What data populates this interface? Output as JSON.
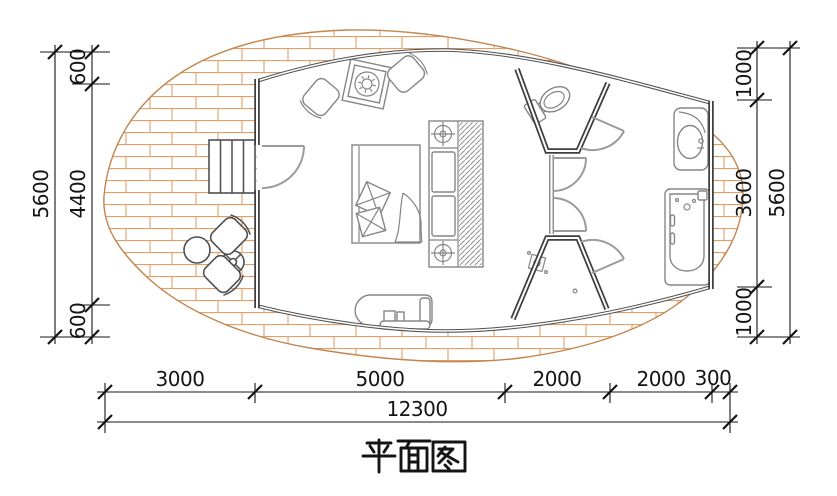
{
  "title": {
    "text": "平面图"
  },
  "dimensions": {
    "left": {
      "overall": "5600",
      "segments": [
        "600",
        "4400",
        "600"
      ]
    },
    "right": {
      "overall": "5600",
      "segments": [
        "1000",
        "3600",
        "1000"
      ]
    },
    "bottom": {
      "overall": "12300",
      "segments": [
        "3000",
        "5000",
        "2000",
        "2000",
        "300"
      ]
    }
  },
  "colors": {
    "brick": "#dfa06a",
    "deck_outline": "#c4854e",
    "wall": "#3f3f3f",
    "window": "#515151",
    "furniture": "#858585",
    "outdoor_furniture": "#4f4f4f",
    "door": "#9b9b9b",
    "dimension": "#141414"
  },
  "fixtures": [
    "entry-steps",
    "entry-door",
    "lounge-chair-left",
    "side-table",
    "lounge-chair-right",
    "double-bed",
    "pillows",
    "blanket",
    "nightstands",
    "ceiling-light-symbols",
    "wardrobe",
    "bench-console",
    "outdoor-chair-a",
    "outdoor-chair-b",
    "outdoor-round-table",
    "parasol-table",
    "toilet",
    "wc-door",
    "double-swing-doors",
    "shower-drain",
    "shower-door",
    "washbasin",
    "bathtub"
  ]
}
